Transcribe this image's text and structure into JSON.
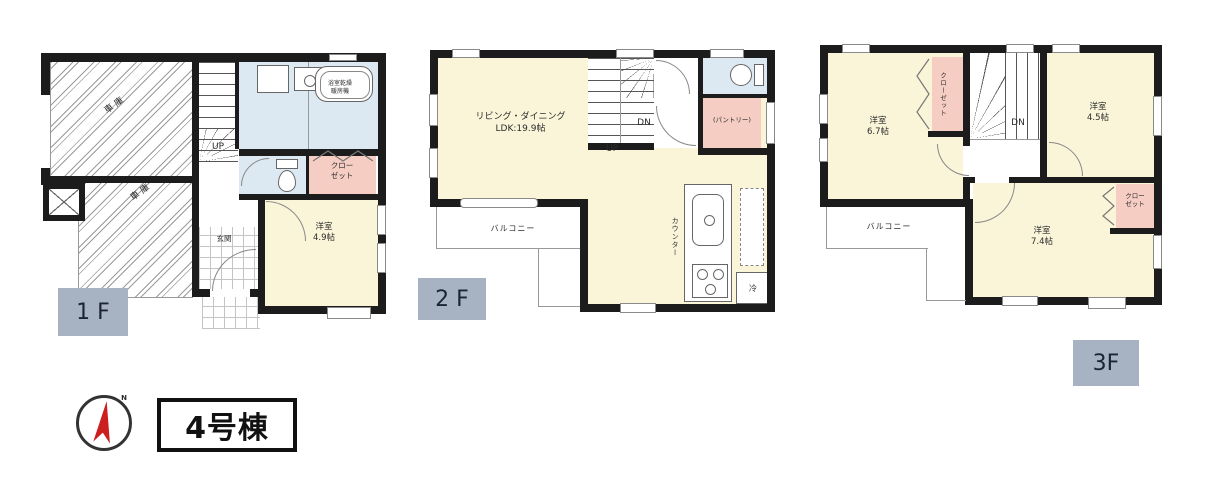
{
  "colors": {
    "wall": "#1c1c1c",
    "room_yellow": "#faf5d8",
    "wet_area_blue": "#dde9f2",
    "closet_pink": "#f6cdc3",
    "floor_badge_gray": "#a7b3c3",
    "compass_red": "#cc1f1f"
  },
  "floor1": {
    "badge": "1 F",
    "garage_upper": "車庫",
    "garage_lower": "車庫",
    "stairs_up": "UP",
    "bath_line1": "浴室乾燥",
    "bath_line2": "暖房機",
    "closet_line1": "クロー",
    "closet_line2": "ゼット",
    "bedroom_line1": "洋室",
    "bedroom_line2": "4.9帖",
    "entrance": "玄関"
  },
  "floor2": {
    "badge": "2 F",
    "living_line1": "リビング・ダイニング",
    "living_line2": "LDK:19.9帖",
    "stairs_up": "UP",
    "stairs_down": "DN",
    "pantry": "(パントリー)",
    "balcony": "バルコニー",
    "counter": "カウンター",
    "fridge": "冷"
  },
  "floor3": {
    "badge": "3F",
    "bedroom1_line1": "洋室",
    "bedroom1_line2": "6.7帖",
    "bedroom2_line1": "洋室",
    "bedroom2_line2": "4.5帖",
    "bedroom3_line1": "洋室",
    "bedroom3_line2": "7.4帖",
    "closet_vertical": "クローゼット",
    "closet_line1": "クロー",
    "closet_line2": "ゼット",
    "stairs_down": "DN",
    "balcony": "バルコニー"
  },
  "building": {
    "label": "4号棟"
  },
  "compass": {
    "north": "N"
  }
}
